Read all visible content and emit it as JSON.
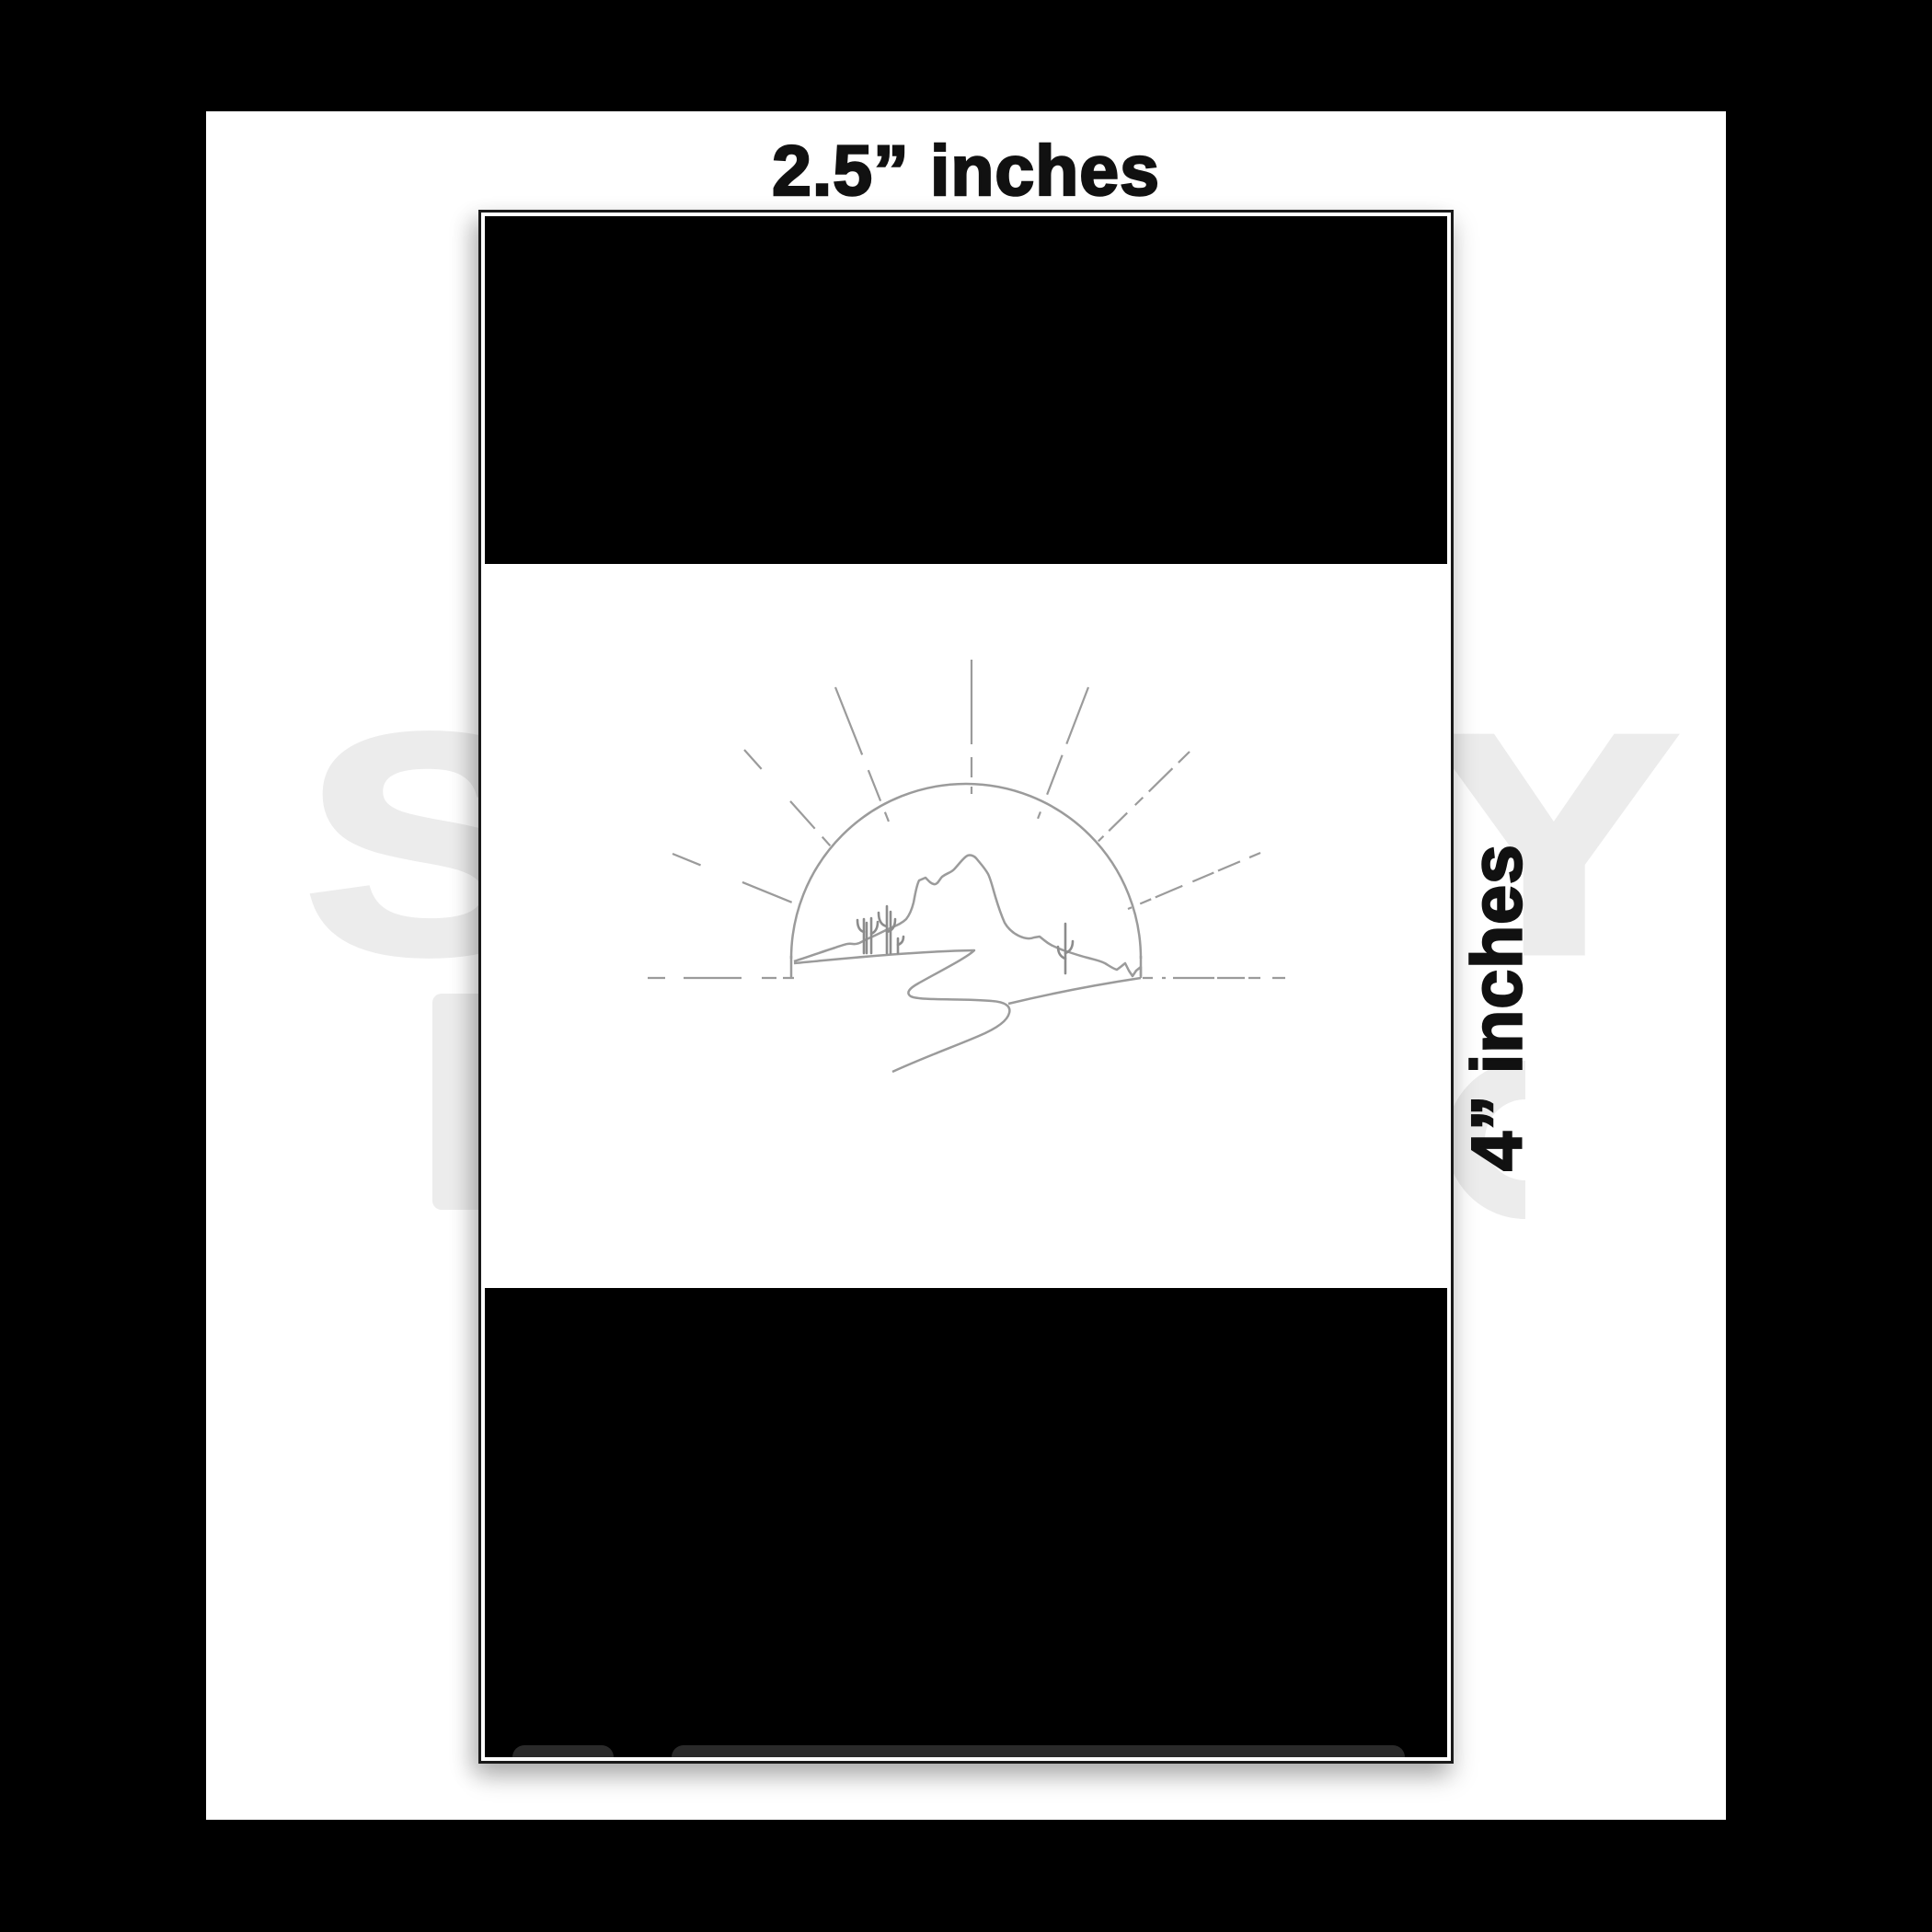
{
  "labels": {
    "width_label": "2.5” inches",
    "height_label": "4” inches"
  },
  "watermark": {
    "line1": "STICKY"
  },
  "card": {
    "top_band": "solid-black",
    "bottom_band": "solid-black",
    "artwork": {
      "name": "desert-sunrise-line-art",
      "elements": [
        "sun-half-circle",
        "dashed-sun-rays",
        "mountain-peak",
        "saguaro-cacti",
        "winding-road",
        "dashed-horizon-line"
      ]
    }
  },
  "colors": {
    "bg": "#000000",
    "sheet": "#ffffff",
    "card-black": "#000000",
    "card-border": "#1a1a1a",
    "strip-gray": "#2a2a2a",
    "line-gray": "#9b9b9b",
    "cactus-gray": "#8c8c8c",
    "watermark": "#ececec",
    "label-ink": "#111111"
  }
}
